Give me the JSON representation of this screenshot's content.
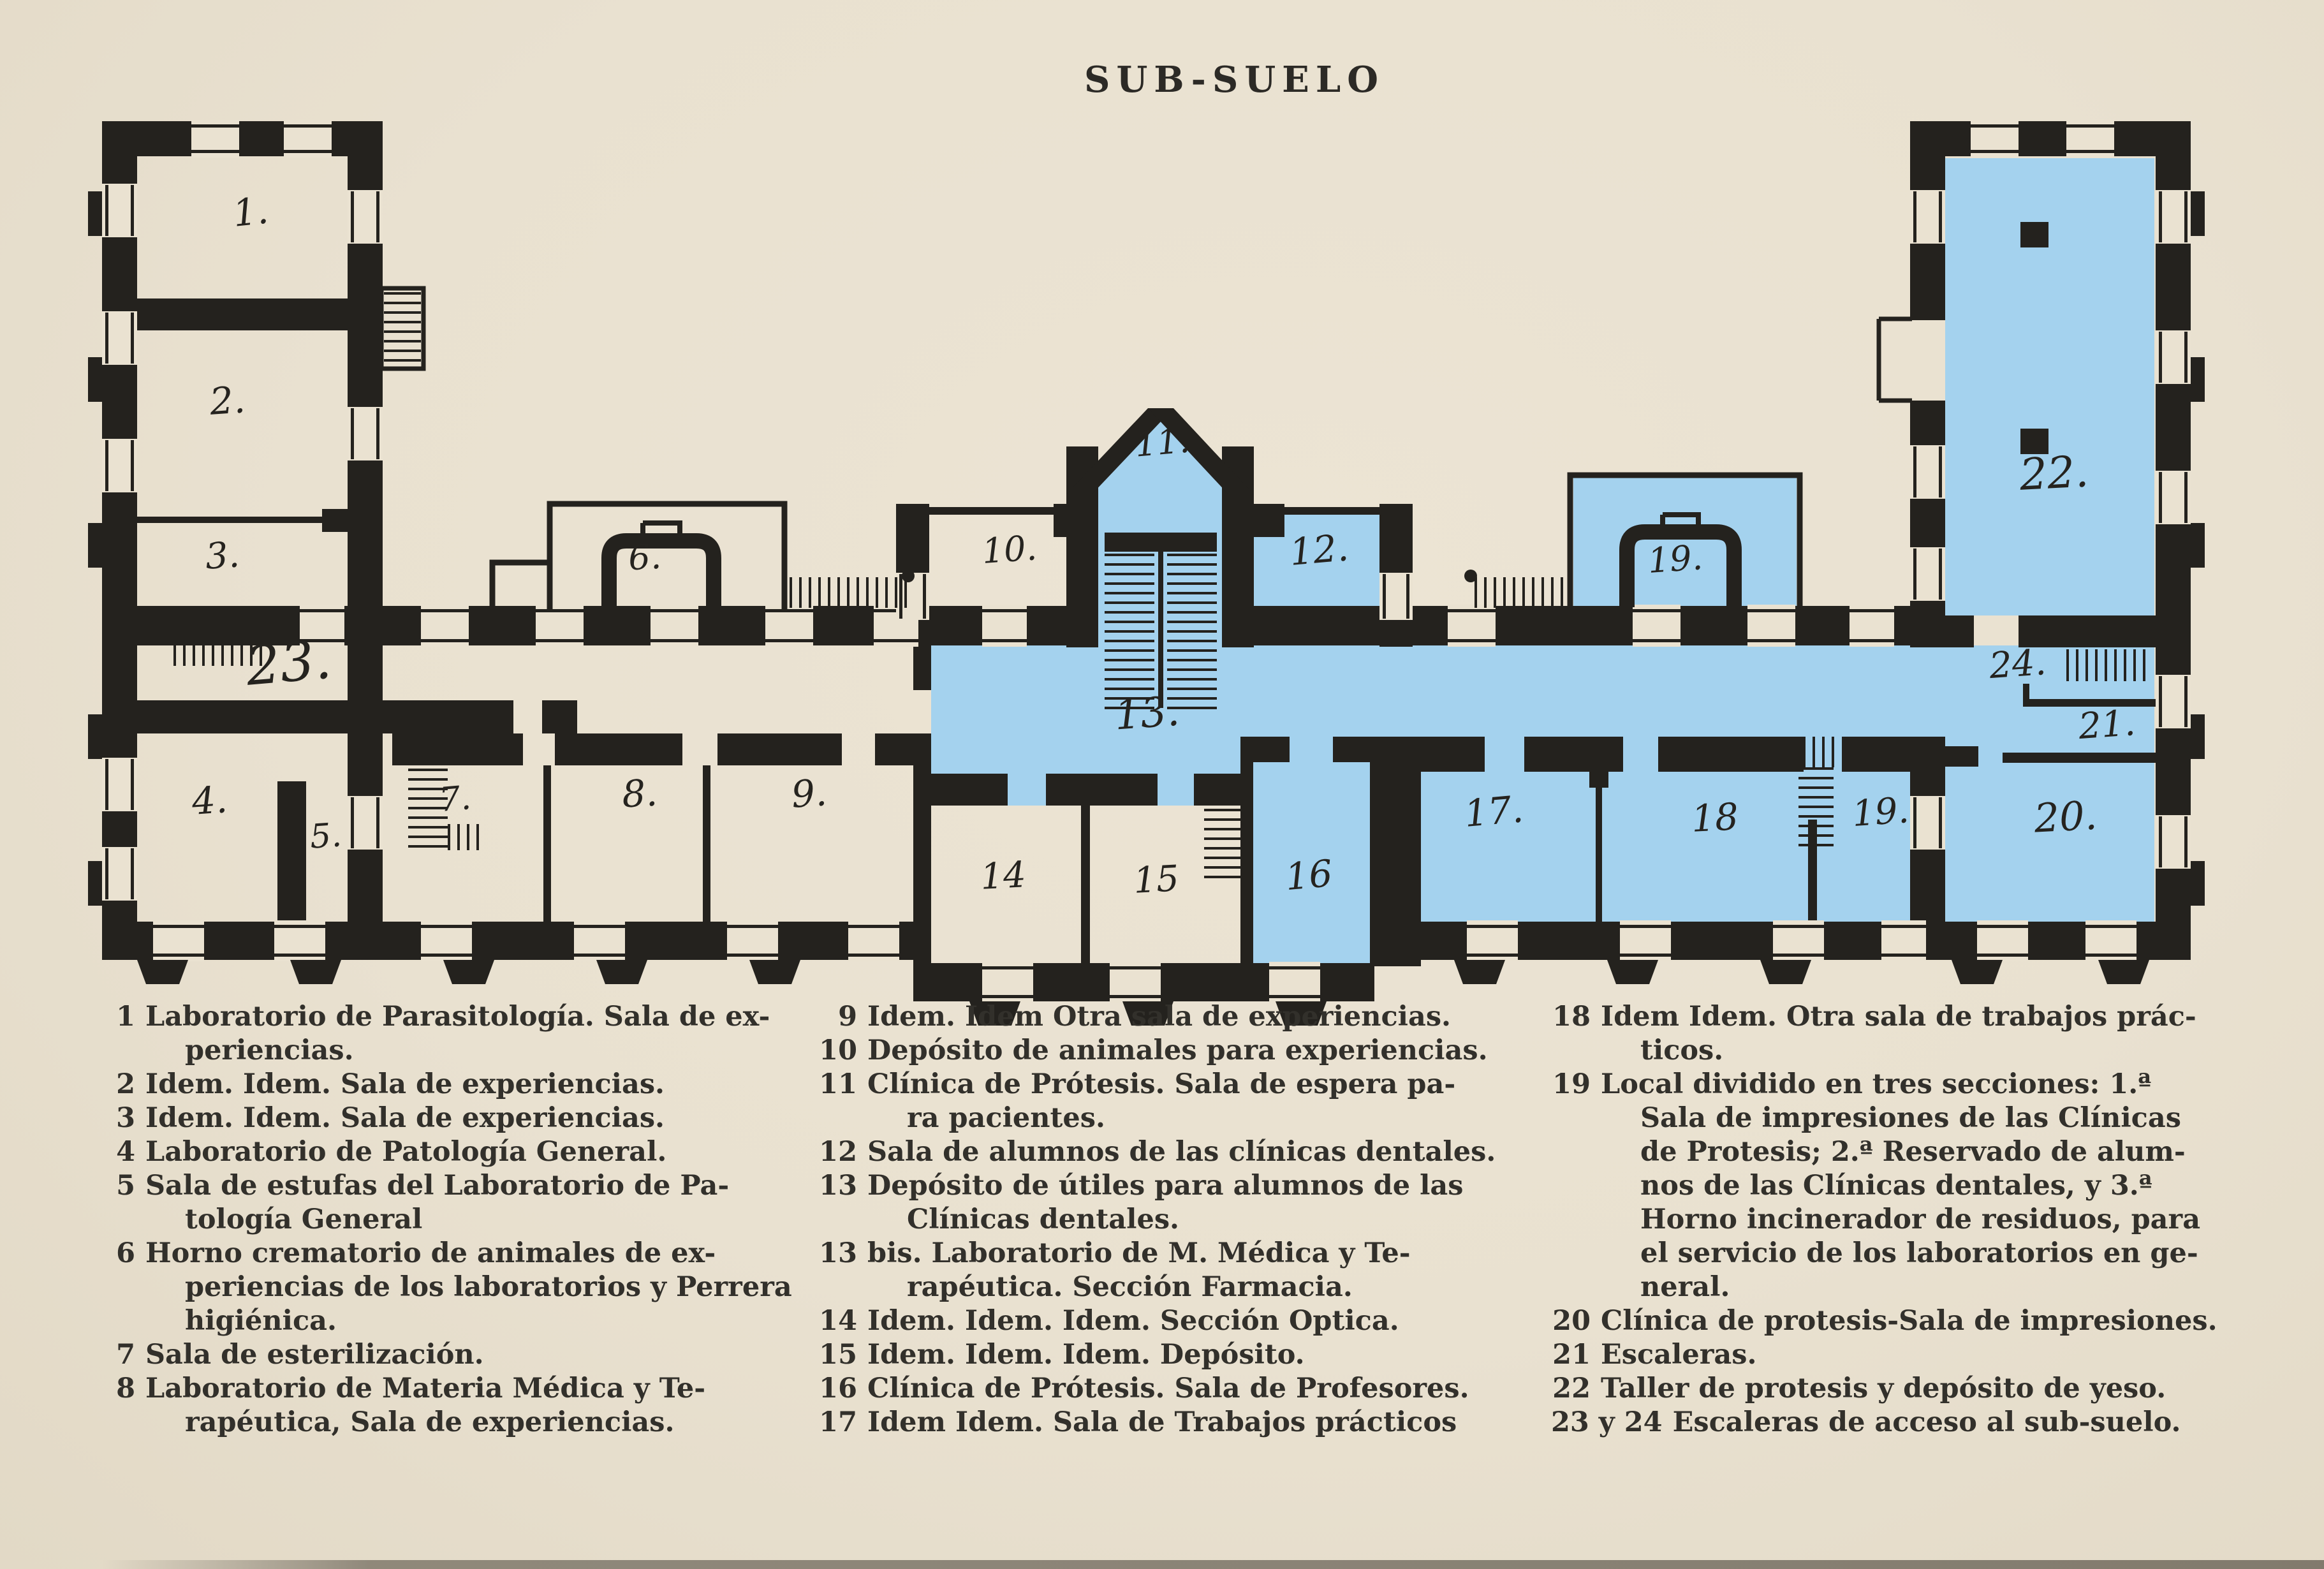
{
  "title": "SUB-SUELO",
  "colors": {
    "paper": "#eae2d1",
    "ink": "#24221e",
    "highlight": "#a4d2ee",
    "text": "#32302b"
  },
  "plan": {
    "highlight_color": "#a4d2ee",
    "highlighted_room_numbers": [
      "11",
      "12",
      "13",
      "16",
      "17",
      "18",
      "19",
      "20",
      "21",
      "22",
      "24"
    ],
    "rooms": [
      {
        "label": "1.",
        "highlighted": false
      },
      {
        "label": "2.",
        "highlighted": false
      },
      {
        "label": "3.",
        "highlighted": false
      },
      {
        "label": "23.",
        "highlighted": false
      },
      {
        "label": "4.",
        "highlighted": false
      },
      {
        "label": "5.",
        "highlighted": false
      },
      {
        "label": "6.",
        "highlighted": false
      },
      {
        "label": "7.",
        "highlighted": false
      },
      {
        "label": "8.",
        "highlighted": false
      },
      {
        "label": "9.",
        "highlighted": false
      },
      {
        "label": "10.",
        "highlighted": false
      },
      {
        "label": "11.",
        "highlighted": true
      },
      {
        "label": "12.",
        "highlighted": true
      },
      {
        "label": "13.",
        "highlighted": true
      },
      {
        "label": "14",
        "highlighted": false
      },
      {
        "label": "15",
        "highlighted": false
      },
      {
        "label": "16",
        "highlighted": true
      },
      {
        "label": "17.",
        "highlighted": true
      },
      {
        "label": "18",
        "highlighted": true
      },
      {
        "label": "19.",
        "highlighted": true
      },
      {
        "label": "19.",
        "highlighted": true
      },
      {
        "label": "22.",
        "highlighted": true
      },
      {
        "label": "24.",
        "highlighted": true
      },
      {
        "label": "21.",
        "highlighted": true
      },
      {
        "label": "20.",
        "highlighted": true
      }
    ]
  },
  "legend": {
    "columns": [
      {
        "items": [
          {
            "num": "1",
            "lines": [
              "Laboratorio de Parasitología. Sala de ex-",
              "periencias."
            ]
          },
          {
            "num": "2",
            "lines": [
              "Idem. Idem. Sala de experiencias."
            ]
          },
          {
            "num": "3",
            "lines": [
              "Idem. Idem. Sala de experiencias."
            ]
          },
          {
            "num": "4",
            "lines": [
              "Laboratorio de Patología General."
            ]
          },
          {
            "num": "5",
            "lines": [
              "Sala de estufas del Laboratorio de Pa-",
              "tología General"
            ]
          },
          {
            "num": "6",
            "lines": [
              "Horno crematorio de animales de ex-",
              "periencias de los laboratorios y Perrera",
              "higiénica."
            ]
          },
          {
            "num": "7",
            "lines": [
              "Sala de esterilización."
            ]
          },
          {
            "num": "8",
            "lines": [
              "Laboratorio de Materia Médica y Te-",
              "rapéutica, Sala de experiencias."
            ]
          }
        ]
      },
      {
        "items": [
          {
            "num": "9",
            "lines": [
              "Idem. Idem Otra sala de experiencias."
            ]
          },
          {
            "num": "10",
            "lines": [
              "Depósito de animales para experiencias."
            ]
          },
          {
            "num": "11",
            "lines": [
              "Clínica de Prótesis. Sala de espera pa-",
              "ra pacientes."
            ]
          },
          {
            "num": "12",
            "lines": [
              "Sala de alumnos de las clínicas dentales."
            ]
          },
          {
            "num": "13",
            "lines": [
              "Depósito de útiles para alumnos de las",
              "Clínicas dentales."
            ]
          },
          {
            "num": "13",
            "lines": [
              "bis. Laboratorio de M. Médica y Te-",
              "rapéutica. Sección Farmacia."
            ]
          },
          {
            "num": "14",
            "lines": [
              "Idem. Idem. Idem. Sección Optica."
            ]
          },
          {
            "num": "15",
            "lines": [
              "Idem. Idem. Idem. Depósito."
            ]
          },
          {
            "num": "16",
            "lines": [
              "Clínica de Prótesis. Sala de Profesores."
            ]
          },
          {
            "num": "17",
            "lines": [
              "Idem Idem. Sala de Trabajos prácticos"
            ]
          }
        ]
      },
      {
        "items": [
          {
            "num": "18",
            "lines": [
              "Idem Idem. Otra sala  de trabajos prác-",
              "ticos."
            ]
          },
          {
            "num": "19",
            "lines": [
              "Local dividido en tres secciones: 1.ª",
              "Sala de impresiones de las Clínicas",
              "de Protesis; 2.ª Reservado de alum-",
              "nos de las Clínicas dentales, y 3.ª",
              "Horno incinerador de residuos, para",
              "el servicio de los laboratorios en ge-",
              "neral."
            ]
          },
          {
            "num": "20",
            "lines": [
              "Clínica de protesis-Sala de impresiones."
            ]
          },
          {
            "num": "21",
            "lines": [
              "Escaleras."
            ]
          },
          {
            "num": "22",
            "lines": [
              "Taller de protesis y depósito de yeso."
            ]
          },
          {
            "num": "23 y 24",
            "lines": [
              "Escaleras de acceso al sub-suelo."
            ]
          }
        ]
      }
    ]
  }
}
